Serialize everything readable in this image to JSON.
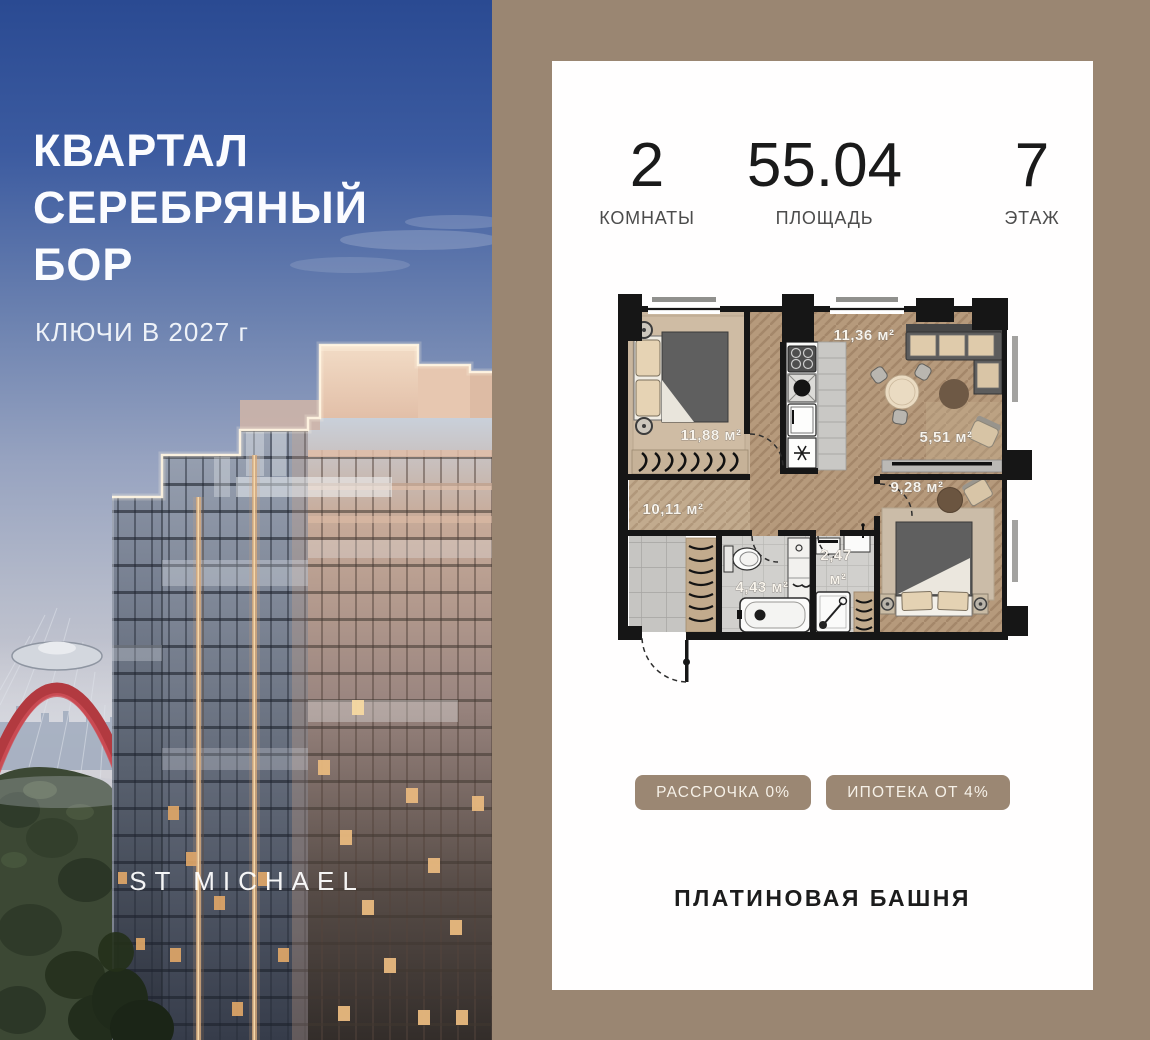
{
  "photo": {
    "title_lines": [
      "КВАРТАЛ",
      "СЕРЕБРЯНЫЙ",
      "БОР"
    ],
    "subtitle": "КЛЮЧИ В 2027 г",
    "watermark": "ST MICHAEL"
  },
  "card": {
    "stats": [
      {
        "value": "2",
        "label": "КОМНАТЫ"
      },
      {
        "value": "55.04",
        "label": "ПЛОЩАДЬ"
      },
      {
        "value": "7",
        "label": "ЭТАЖ"
      }
    ],
    "floor_plan": {
      "labels": {
        "bedroom_large": "11,88 м²",
        "kitchen_living": "11,36 м²",
        "niche": "5,51 м²",
        "bedroom_small": "9,28 м²",
        "hallway": "10,11 м²",
        "bathroom": "4,43 м²",
        "wc_value": "2,47",
        "wc_unit": "м²"
      }
    },
    "promo_badges": [
      {
        "label": "РАССРОЧКА 0%"
      },
      {
        "label": "ИПОТЕКА ОТ 4%"
      }
    ],
    "building_name": "ПЛАТИНОВАЯ БАШНЯ"
  },
  "colors": {
    "panel_bg": "#9a8672",
    "badge_bg": "#9b8773",
    "card_bg": "#fffefe",
    "stat_number": "#1a1a1a",
    "stat_label": "#4c4c4c",
    "plan_wall": "#161616",
    "bridge_red": "#b23a40",
    "sky_top": "#2a4a92"
  }
}
